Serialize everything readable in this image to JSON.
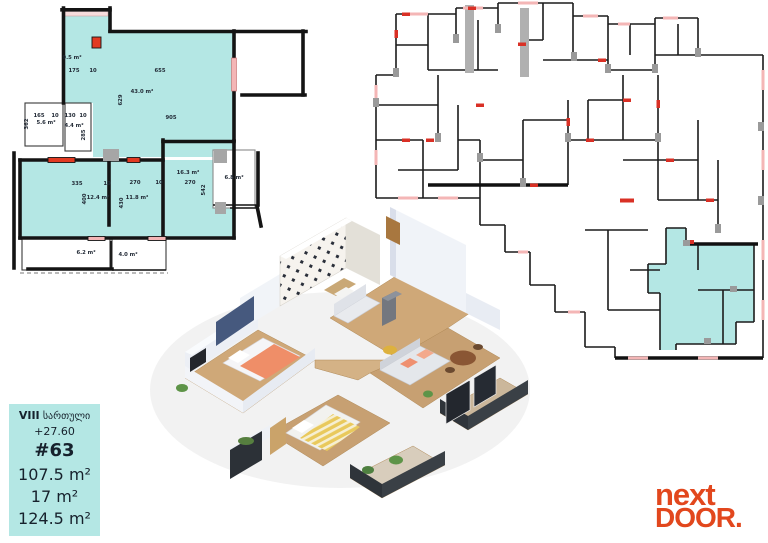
{
  "colors": {
    "highlight": "#b4e7e4",
    "wall": "#141414",
    "door_red": "#e23a22",
    "window_pink": "#f4b6b6",
    "column_gray": "#a6a6a6",
    "label_ink": "#1f2733",
    "brand_orange": "#e2471d"
  },
  "info_box": {
    "floor_roman": "VIII",
    "floor_word": "სართული",
    "elevation": "+27.60",
    "unit_number": "#63",
    "area_apartment": "107.5 m²",
    "area_balcony": "17 m²",
    "area_total": "124.5 m²"
  },
  "logo": {
    "line1": "next",
    "line2": "DOOR",
    "dot": "."
  },
  "unit_plan": {
    "labels": [
      {
        "t": "9.5 m²",
        "x": 64,
        "y": 56
      },
      {
        "t": "175",
        "x": 66,
        "y": 69
      },
      {
        "t": "10",
        "x": 85,
        "y": 69
      },
      {
        "t": "655",
        "x": 152,
        "y": 69
      },
      {
        "t": "43.0 m²",
        "x": 134,
        "y": 90
      },
      {
        "t": "629",
        "x": 114,
        "y": 97,
        "r": -90
      },
      {
        "t": "905",
        "x": 163,
        "y": 116
      },
      {
        "t": "165",
        "x": 31,
        "y": 114
      },
      {
        "t": "10",
        "x": 47,
        "y": 114
      },
      {
        "t": "362",
        "x": 20,
        "y": 121,
        "r": -90
      },
      {
        "t": "5.6 m²",
        "x": 38,
        "y": 121
      },
      {
        "t": "130",
        "x": 62,
        "y": 114
      },
      {
        "t": "10",
        "x": 75,
        "y": 114
      },
      {
        "t": "4.4 m²",
        "x": 66,
        "y": 124
      },
      {
        "t": "285",
        "x": 77,
        "y": 132,
        "r": -90
      },
      {
        "t": "335",
        "x": 69,
        "y": 182
      },
      {
        "t": "10",
        "x": 99,
        "y": 182
      },
      {
        "t": "400",
        "x": 78,
        "y": 196,
        "r": -90
      },
      {
        "t": "12.4 m²",
        "x": 90,
        "y": 196
      },
      {
        "t": "270",
        "x": 127,
        "y": 181
      },
      {
        "t": "10",
        "x": 151,
        "y": 181
      },
      {
        "t": "430",
        "x": 115,
        "y": 200,
        "r": -90
      },
      {
        "t": "11.8 m²",
        "x": 129,
        "y": 196
      },
      {
        "t": "16.3 m²",
        "x": 180,
        "y": 171
      },
      {
        "t": "270",
        "x": 182,
        "y": 181
      },
      {
        "t": "542",
        "x": 197,
        "y": 187,
        "r": -90
      },
      {
        "t": "6.8 m²",
        "x": 226,
        "y": 176
      },
      {
        "t": "6.2 m²",
        "x": 78,
        "y": 251
      },
      {
        "t": "4.0 m²",
        "x": 120,
        "y": 253
      }
    ]
  }
}
